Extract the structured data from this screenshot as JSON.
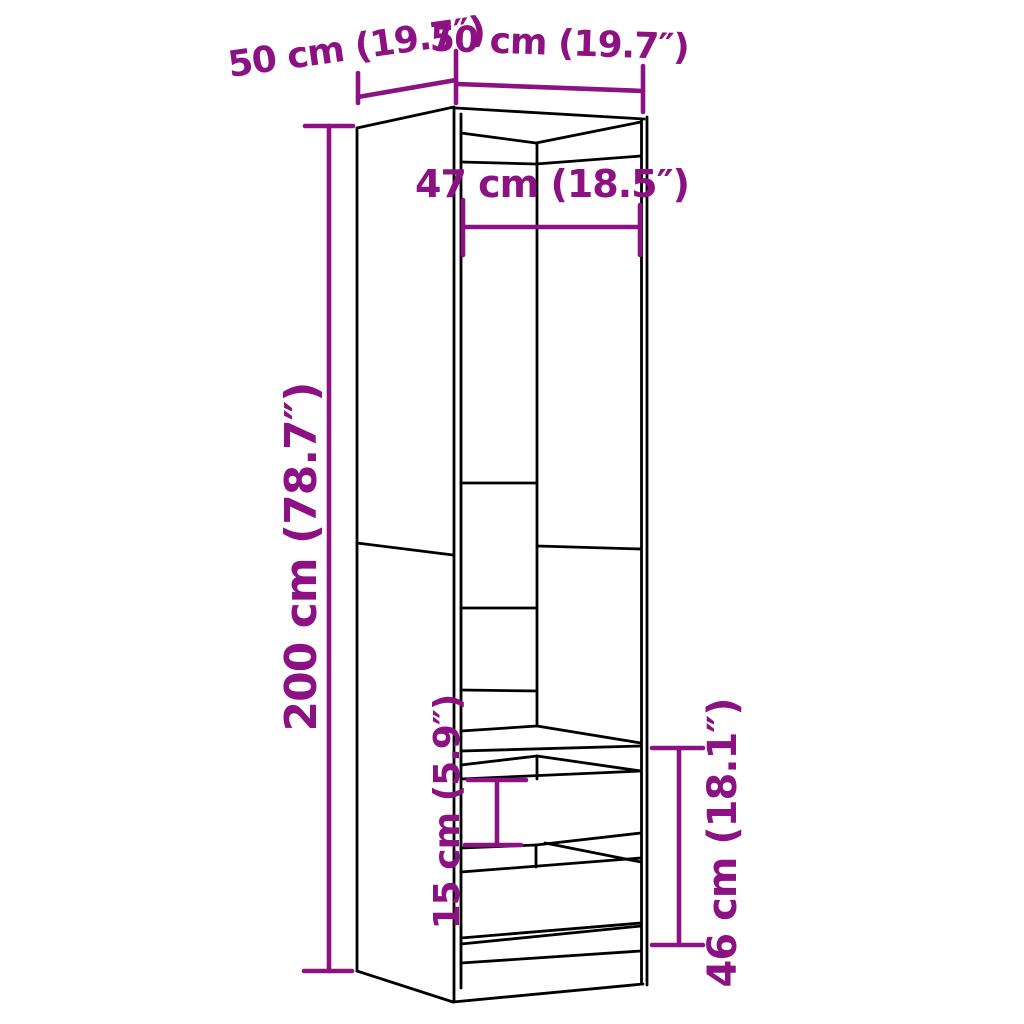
{
  "diagram": {
    "type": "furniture-dimension-diagram",
    "product": "tall wardrobe cabinet with open top section and two drawers",
    "colors": {
      "dimension_accent": "#8C1183",
      "line_art": "#000000",
      "background": "#FFFFFF"
    },
    "labels": {
      "depth_top": "50 cm (19.7″)",
      "width_top": "50 cm (19.7″)",
      "interior_width": "47 cm (18.5″)",
      "height": "200 cm (78.7″)",
      "drawer_front_height": "15 cm (5.9″)",
      "bottom_section_height": "46 cm (18.1″)"
    },
    "dimensions": [
      {
        "part": "depth",
        "value": 50,
        "unit": "cm",
        "inches": 19.7
      },
      {
        "part": "width",
        "value": 50,
        "unit": "cm",
        "inches": 19.7
      },
      {
        "part": "interior width",
        "value": 47,
        "unit": "cm",
        "inches": 18.5
      },
      {
        "part": "overall height",
        "value": 200,
        "unit": "cm",
        "inches": 78.7
      },
      {
        "part": "drawer front height",
        "value": 15,
        "unit": "cm",
        "inches": 5.9
      },
      {
        "part": "bottom section height",
        "value": 46,
        "unit": "cm",
        "inches": 18.1
      }
    ]
  }
}
